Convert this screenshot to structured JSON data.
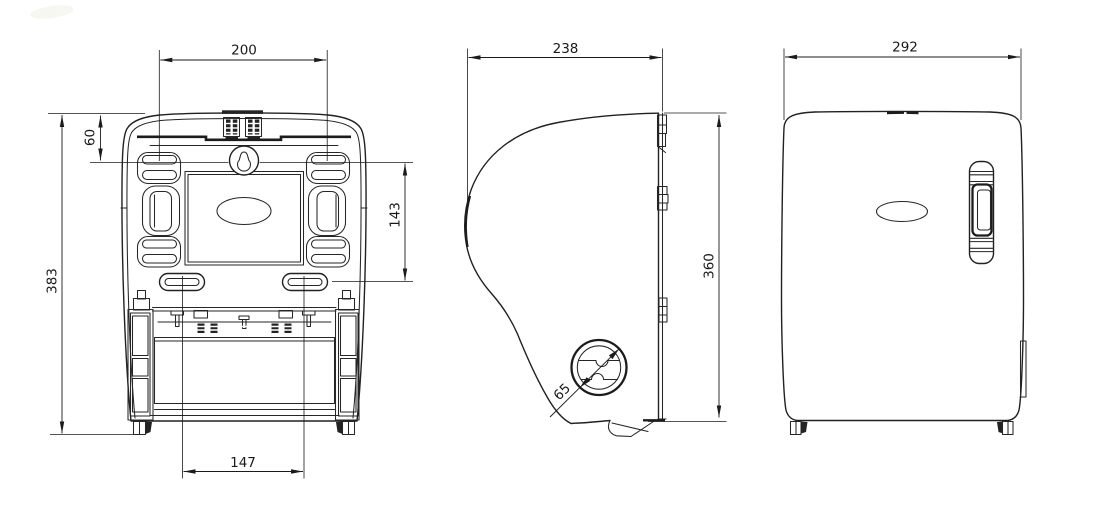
{
  "drawing": {
    "background": "#ffffff",
    "line_color": "#212121",
    "views": {
      "back": {
        "dimensions": {
          "mount_hole_spacing_width": "200",
          "top_edge_to_mount_holes": "60",
          "overall_height": "383",
          "mount_hole_column_height": "143",
          "lower_slot_spacing": "147"
        }
      },
      "side": {
        "dimensions": {
          "overall_depth": "238",
          "back_plate_height": "360",
          "knob_diameter": "65"
        }
      },
      "front": {
        "dimensions": {
          "overall_width": "292"
        }
      }
    },
    "icons": {
      "keyhole_mount": "keyhole-shape",
      "turn_knob": "circular-dial-with-s-slot"
    }
  }
}
